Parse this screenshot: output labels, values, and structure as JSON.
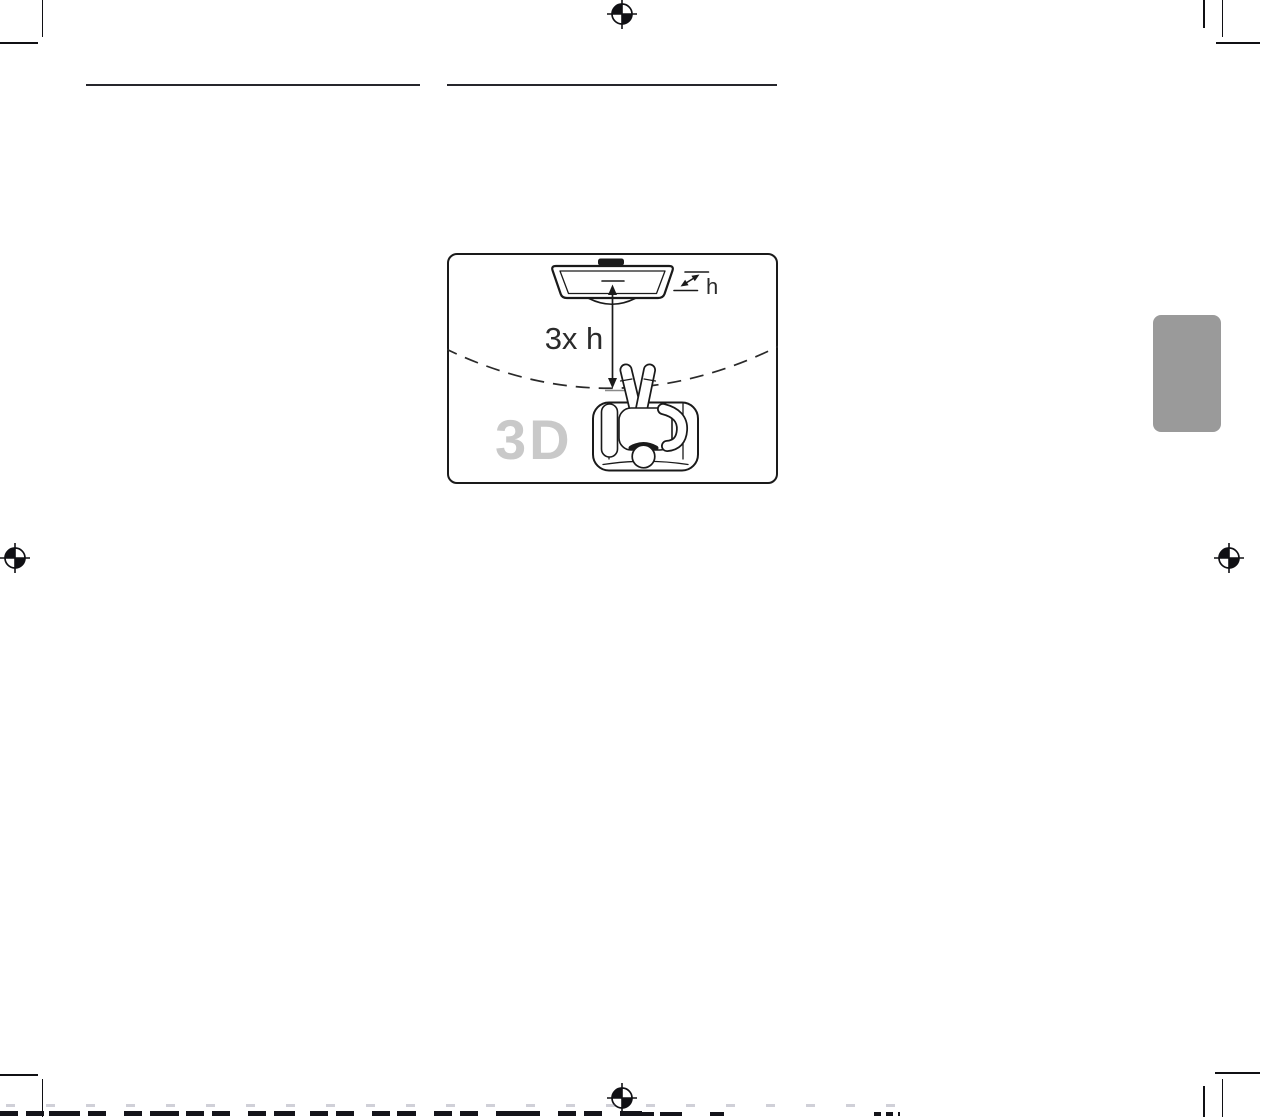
{
  "diagram": {
    "labels": {
      "distance": "3x h",
      "screen_height": "h",
      "watermark": "3D"
    },
    "colors": {
      "line": "#1a1a1a",
      "watermark": "#c9c9c9",
      "box_border": "#1a1a1a",
      "background": "#ffffff"
    }
  },
  "page": {
    "background": "#ffffff",
    "print_mark_color": "#101014",
    "heading_rule_color": "#26262c"
  },
  "section_tab": {
    "color": "#9a9a9a"
  }
}
